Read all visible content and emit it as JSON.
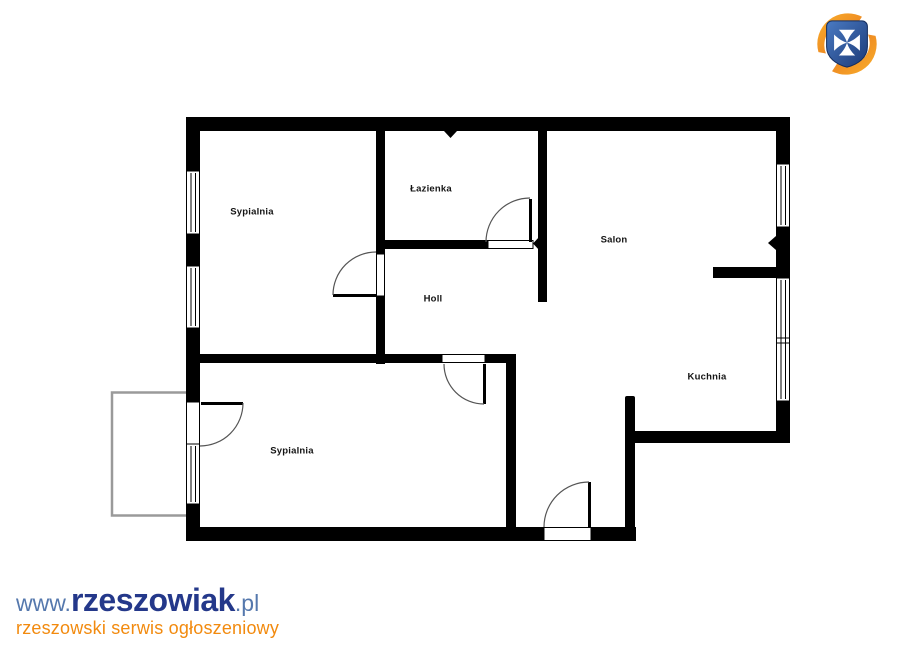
{
  "floor_plan": {
    "rooms": [
      {
        "name": "Sypialnia"
      },
      {
        "name": "Łazienka"
      },
      {
        "name": "Holl"
      },
      {
        "name": "Salon"
      },
      {
        "name": "Kuchnia"
      },
      {
        "name": "Sypialnia"
      }
    ],
    "wall_color": "#000000",
    "door_arc_color": "#555555",
    "balcony_outline_color": "#9a9a9a"
  },
  "logo": {
    "label": "rzeszowiak.pl logo",
    "shield_color": "#2a55a0",
    "cross_color": "#ffffff",
    "swoosh_color": "#f0941e"
  },
  "branding": {
    "url_prefix": "www.",
    "brand": "rzeszowiak",
    "url_suffix": ".pl",
    "tagline": "rzeszowski serwis ogłoszeniowy",
    "brand_color": "#24388a",
    "url_color": "#5578ad",
    "tagline_color": "#f28a0e"
  }
}
